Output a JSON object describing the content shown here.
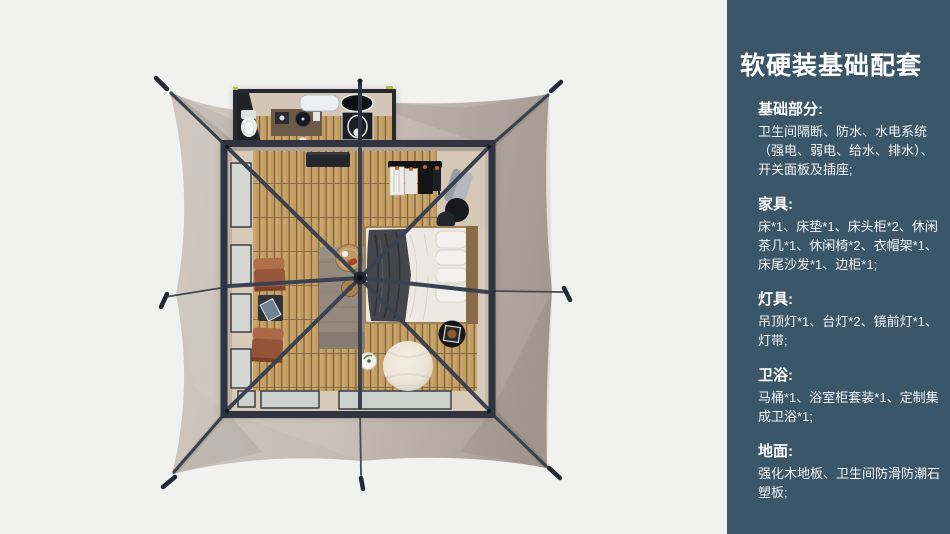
{
  "panel": {
    "title": "软硬装基础配套",
    "sections": [
      {
        "heading": "基础部分:",
        "body": "卫生间隔断、防水、水电系统（强电、弱电、给水、排水）、开关面板及插座;"
      },
      {
        "heading": "家具:",
        "body": "床*1、床垫*1、床头柜*2、休闲茶几*1、休闲椅*2、衣帽架*1、床尾沙发*1、边柜*1;"
      },
      {
        "heading": "灯具:",
        "body": "吊顶灯*1、台灯*2、镜前灯*1、灯带;"
      },
      {
        "heading": "卫浴:",
        "body": "马桶*1、浴室柜套装*1、定制集成卫浴*1;"
      },
      {
        "heading": "地面:",
        "body": "强化木地板、卫生间防滑防潮石塑板;"
      }
    ]
  },
  "palette": {
    "slide_background": "#F1F1F0",
    "panel_background": "#3A5668",
    "panel_text": "#FFFFFF",
    "tent_canvas_light": "#CDC5BE",
    "tent_canvas_dark": "#AAA099",
    "frame_dark": "#2F3440",
    "wood_floor": "#C49D63",
    "rug": "#95897D",
    "leather_chair": "#98563A",
    "bed_linen": "#ECE9E3",
    "accent_lime": "#B6C23C"
  }
}
